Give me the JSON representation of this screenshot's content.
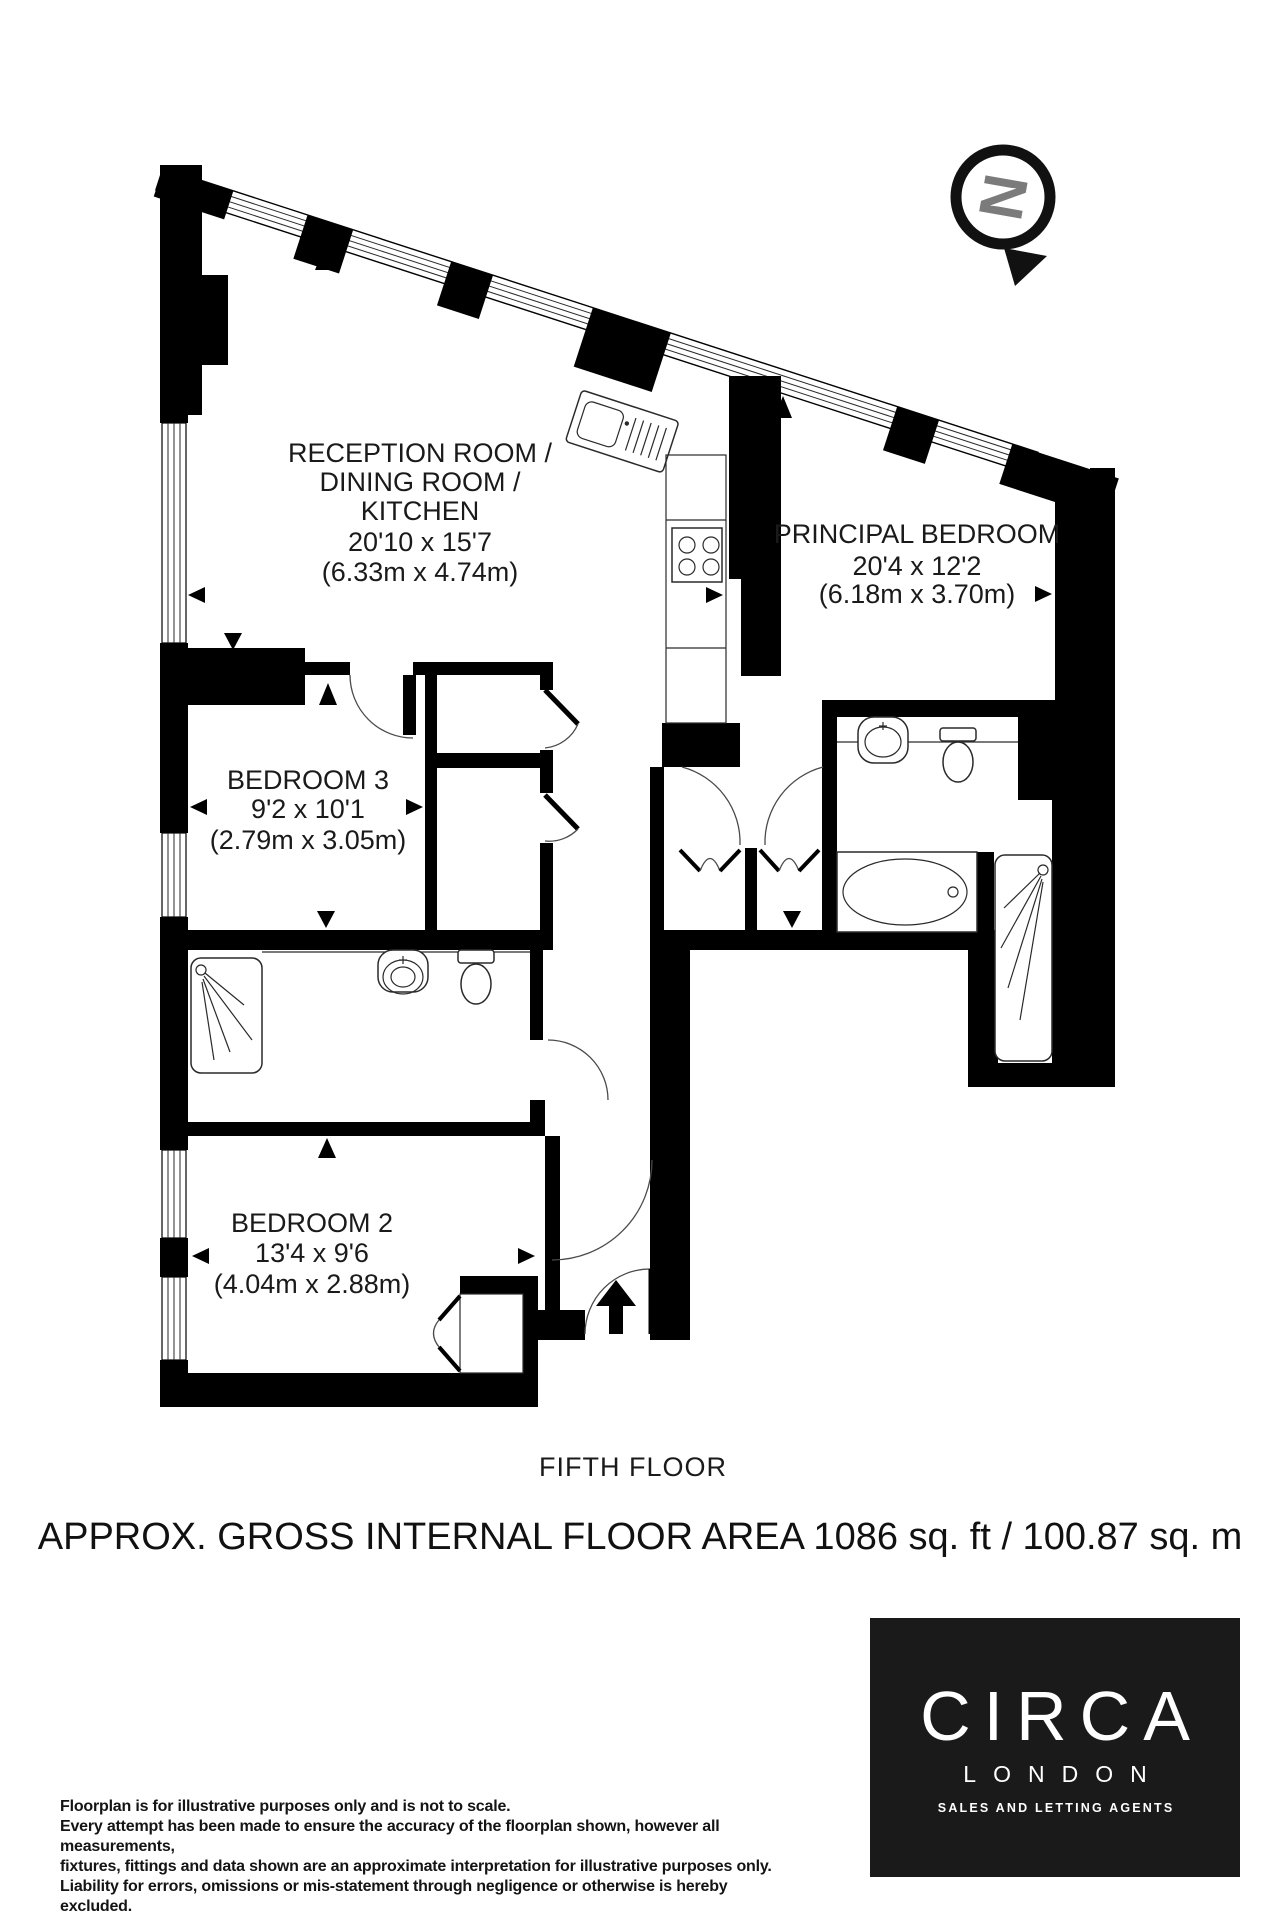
{
  "plan": {
    "compass": {
      "letter": "N"
    },
    "rooms": [
      {
        "id": "reception",
        "name_lines": [
          "RECEPTION ROOM /",
          "DINING ROOM /",
          "KITCHEN"
        ],
        "dim_imperial": "20'10 x 15'7",
        "dim_metric": "(6.33m x 4.74m)"
      },
      {
        "id": "principal-bedroom",
        "name_lines": [
          "PRINCIPAL BEDROOM"
        ],
        "dim_imperial": "20'4 x 12'2",
        "dim_metric": "(6.18m x 3.70m)"
      },
      {
        "id": "bedroom-3",
        "name_lines": [
          "BEDROOM 3"
        ],
        "dim_imperial": "9'2 x 10'1",
        "dim_metric": "(2.79m x 3.05m)"
      },
      {
        "id": "bedroom-2",
        "name_lines": [
          "BEDROOM 2"
        ],
        "dim_imperial": "13'4 x 9'6",
        "dim_metric": "(4.04m x 2.88m)"
      }
    ],
    "floor_label": "FIFTH FLOOR"
  },
  "area_summary": "APPROX. GROSS INTERNAL FLOOR AREA 1086 sq. ft / 100.87 sq. m",
  "disclaimer_lines": [
    "Floorplan is for illustrative purposes only and is not to scale.",
    "Every attempt has been made to ensure the accuracy of the floorplan shown, however all measurements,",
    "fixtures, fittings and data shown are an approximate interpretation for illustrative purposes only.",
    "Liability for errors, omissions or mis-statement through negligence or otherwise is hereby excluded."
  ],
  "logo": {
    "brand": "CIRCA",
    "city": "LONDON",
    "tagline": "SALES AND LETTING AGENTS"
  },
  "colors": {
    "wall": "#000000",
    "label_text": "#1a1a1a",
    "compass_gray": "#7b7b7b",
    "logo_bg": "#1a1a1a",
    "logo_text": "#ffffff"
  }
}
